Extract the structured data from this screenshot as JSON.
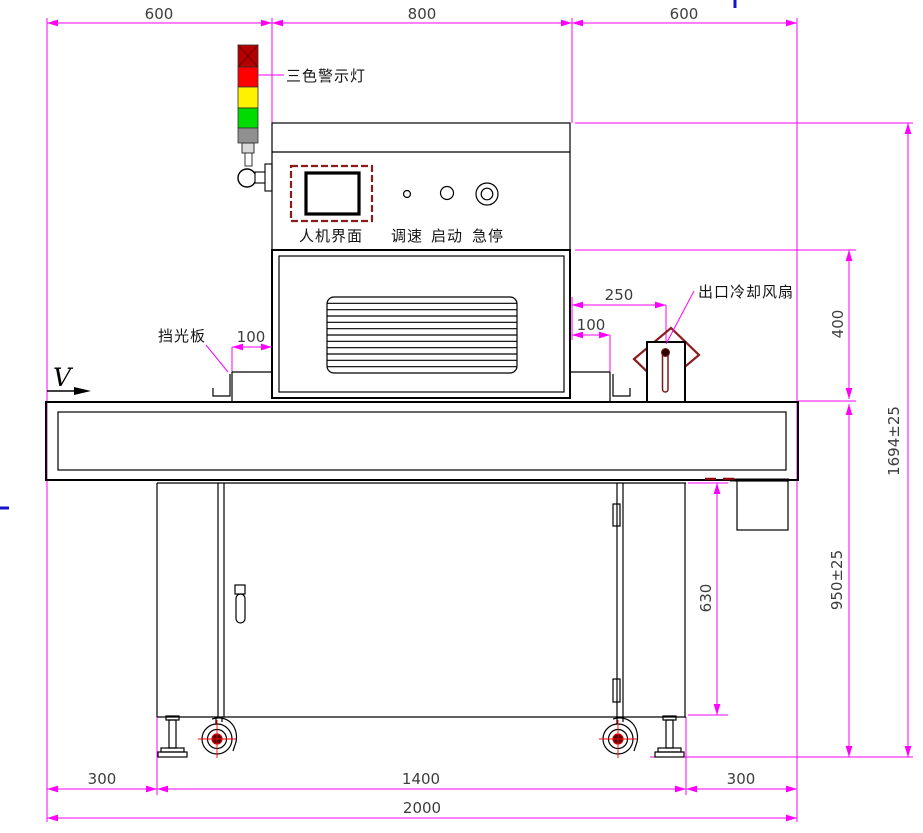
{
  "drawing": {
    "title": "machine-front-view-dimension-drawing",
    "colors": {
      "dimension_line": "#FF00FF",
      "outline": "#000000",
      "dim_text": "#3D3D3D",
      "label_text": "#141414",
      "maroon": "#8B1C1C",
      "cap_red": "#B40000",
      "red": "#FF0000",
      "yellow": "#FFF200",
      "green": "#00DC00",
      "gray": "#909090",
      "stray_blue": "#1414CC"
    },
    "labels": {
      "warning_light": "三色警示灯",
      "hmi": "人机界面",
      "speed_knob": "调速",
      "start_button": "启动",
      "estop_button": "急停",
      "light_shield": "挡光板",
      "outlet_fan": "出口冷却风扇",
      "direction": "V"
    },
    "dims": {
      "top_left": "600",
      "top_mid": "800",
      "top_right": "600",
      "shield_left": "100",
      "fan_offset": "250",
      "shield_right": "100",
      "oven_to_belt": "400",
      "overall_height": "1694±25",
      "belt_height": "950±25",
      "cabinet_height": "630",
      "bottom_left": "300",
      "bottom_mid": "1400",
      "bottom_right": "300",
      "overall_width": "2000"
    }
  }
}
